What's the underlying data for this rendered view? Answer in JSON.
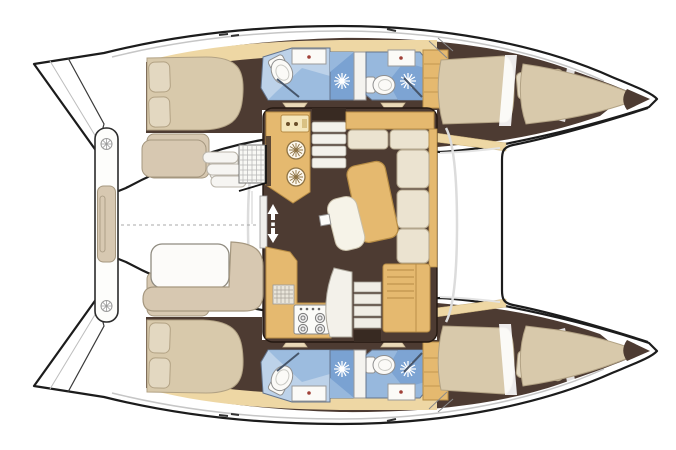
{
  "scene": {
    "description": "Top-down interior floor plan of a twin-hull sailing catamaran, bow pointing right, no text labels rendered",
    "hull_count": 2,
    "cabin_count": 4,
    "head_count": 4
  },
  "colors": {
    "background": "#ffffff",
    "outline": "#1c1c1c",
    "floor": "#4d3b32",
    "floorDark": "#382a22",
    "wood": "#e5b96f",
    "woodDark": "#b68c45",
    "woodLight": "#eed7a4",
    "cream": "#ebe3d0",
    "creamStroke": "#b3a68c",
    "bed": "#d8c9ab",
    "bedStroke": "#b2a284",
    "pillow": "#e3d8c1",
    "seat": "#d7c8b1",
    "seatStroke": "#a5977f",
    "bathLight": "#bdd2e9",
    "bathMed": "#97b8dd",
    "bathDark": "#7aa2d2",
    "fixture": "#fbfaf7",
    "fixtureStroke": "#8f8f8f",
    "glass": "#47566b",
    "grayLine": "#c6c6c6",
    "faucetDot": "#a04038"
  },
  "parts": {
    "port_hull": {
      "aft_cabin": [
        "double-bed",
        "two-pillows",
        "sofa-seat",
        "side-table"
      ],
      "aft_head": [
        "toilet",
        "washbasin",
        "glass-screen"
      ],
      "shower_stall": [
        "shower-rose",
        "door"
      ],
      "forward_head": [
        "toilet",
        "washbasin",
        "shower-rose",
        "glass-screen"
      ],
      "forward_cabin": [
        "double-berth",
        "two-pillows",
        "bow-berth"
      ],
      "wardrobe": [
        "shelves"
      ]
    },
    "starboard_hull": "mirror image of port hull",
    "salon": {
      "galley_forward": [
        "counter",
        "twin-round-sinks",
        "appliance"
      ],
      "galley_aft": [
        "counter",
        "four-burner-stove",
        "grid-appliance",
        "worktop"
      ],
      "dinette": [
        "l-shaped-sofa",
        "wood-dining-table",
        "chaise-seat",
        "mast-post"
      ],
      "companionways": [
        "port-stairs",
        "starboard-stairs"
      ],
      "entry": [
        "sliding-door",
        "up-down-arrows"
      ],
      "nav_locker": [
        "slatted-top"
      ]
    },
    "cockpit": [
      "aft-bench",
      "bench-cushion",
      "deck-rings",
      "side-seat",
      "steps",
      "grate-module",
      "cockpit-table",
      "l-settee"
    ],
    "foredeck": [
      "trampoline"
    ]
  }
}
